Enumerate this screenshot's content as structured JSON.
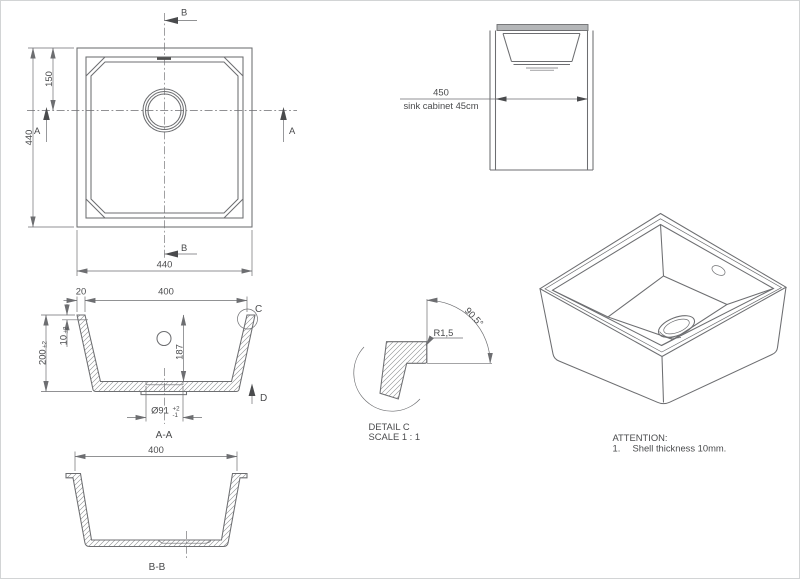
{
  "colors": {
    "line": "#6d6e71",
    "text": "#4a4b4d",
    "counter_fill": "#b4b6b8",
    "background": "#ffffff"
  },
  "views": {
    "top_view": {
      "section_b_top": "B",
      "section_b_bottom": "B",
      "section_a_left": "A",
      "section_a_right": "A",
      "dim_height": "440",
      "dim_drain_from_top": "150",
      "dim_width": "440"
    },
    "cabinet_view": {
      "dim_width": "450",
      "caption": "sink cabinet 45cm"
    },
    "section_aa": {
      "title": "A-A",
      "dim_rim": "20",
      "dim_inner_width": "400",
      "dim_height": "200",
      "dim_height_tol": "±2",
      "dim_shell": "10",
      "dim_shell_tol": "±2",
      "dim_depth": "187",
      "dim_drain": "Ø91",
      "dim_drain_tol_plus": "+2",
      "dim_drain_tol_minus": "-1",
      "detail_label": "C",
      "view_label": "D"
    },
    "detail_c": {
      "radius": "R1,5",
      "angle": "90.5°",
      "title": "DETAIL C",
      "scale": "SCALE 1 : 1"
    },
    "section_bb": {
      "title": "B-B",
      "dim_width": "400"
    },
    "notes": {
      "title": "ATTENTION:",
      "item_number": "1.",
      "item_text": "Shell thickness 10mm."
    }
  }
}
